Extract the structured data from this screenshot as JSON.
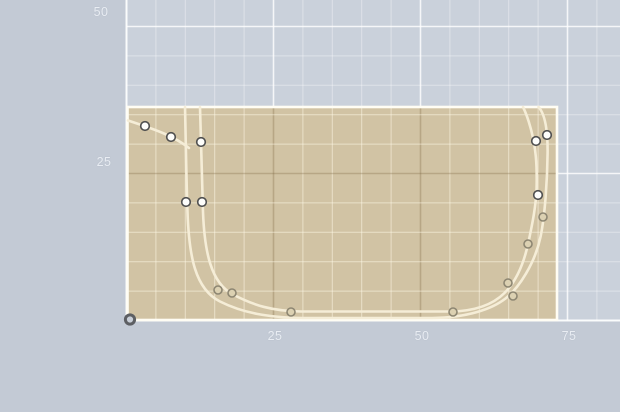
{
  "app": {
    "type": "2d-sketch-editor-canvas",
    "description": "CAD sketch canvas showing a filled profile sheet with bezier outline walls and control points"
  },
  "canvas": {
    "width": 620,
    "height": 412,
    "origin_px": {
      "x": 126.5,
      "y": 320.5
    },
    "px_per_unit": 5.88,
    "minor_step_units": 5,
    "major_step_units": 25,
    "colors": {
      "bg_outside": "#c3cad5",
      "bg_inside": "#cad1db",
      "grid_minor": "rgba(255,255,255,0.38)",
      "grid_major": "rgba(255,255,255,0.80)",
      "axis_line": "rgba(255,255,255,0.92)",
      "label_text": "#e9edf3",
      "sheet_fill": "#d1c3a4",
      "sheet_edge": "#fffdf4",
      "sheet_grid_minor": "rgba(255,250,232,0.55)",
      "sheet_grid_major": "rgba(122,100,62,0.30)",
      "curve": "#f5edd7",
      "point_bright_fill": "#fdfdfb",
      "point_bright_stroke": "#4f4f4f",
      "point_faint_fill": "#dcd1b2",
      "point_faint_stroke": "#8d8672",
      "origin_ring": "#5d5f63",
      "origin_fill": "#c9cfd8"
    }
  },
  "axis_labels": [
    {
      "axis": "y",
      "text": "50",
      "x": 101,
      "y": 12
    },
    {
      "axis": "y",
      "text": "25",
      "x": 104,
      "y": 162
    },
    {
      "axis": "x",
      "text": "25",
      "x": 275,
      "y": 336
    },
    {
      "axis": "x",
      "text": "50",
      "x": 422,
      "y": 336
    },
    {
      "axis": "x",
      "text": "75",
      "x": 569,
      "y": 336
    }
  ],
  "sheet": {
    "x": 127.5,
    "y": 107,
    "width": 429.5,
    "height": 213
  },
  "profile": {
    "stroke_width": 2.6,
    "paths": [
      {
        "name": "outer-wall-path",
        "d": "M 185,107 C 185.8,140 186.2,175 187.5,212 C 189,256 195,289 220,301.5 C 243,313 268,317.5 303,318 L 432,318 C 468,317.5 492,309 505.5,298.5 C 519,288 535,263 540.5,237 C 545,215.5 547.3,180 547.6,153 C 547.8,130 545,114 538.5,107"
      },
      {
        "name": "inner-wall-path",
        "d": "M 200,107 C 201,140 201.8,175 203,212 C 204.5,252 211,283 233,294.5 C 254,305.5 272,311 301,311.5 L 451,311.5 C 478,311 494,303.5 504.5,293 C 517,280.5 524.5,261 528.6,241.5 C 532.5,223 536,206 536.6,188 C 537.2,163 535.5,147 531.5,131.5 C 528.5,119.5 525.5,112 523,107"
      },
      {
        "name": "top-left-detail-path",
        "d": "M 128,120.5 C 137,123.5 151,128 164,133.5 C 173,137.5 182,142.5 189,148"
      }
    ],
    "control_points": [
      {
        "x": 145,
        "y": 126,
        "style": "bright"
      },
      {
        "x": 171,
        "y": 137,
        "style": "bright"
      },
      {
        "x": 201,
        "y": 142,
        "style": "bright"
      },
      {
        "x": 186,
        "y": 202,
        "style": "bright"
      },
      {
        "x": 202,
        "y": 202,
        "style": "bright"
      },
      {
        "x": 218,
        "y": 290,
        "style": "faint"
      },
      {
        "x": 232,
        "y": 293,
        "style": "faint"
      },
      {
        "x": 291,
        "y": 312,
        "style": "faint"
      },
      {
        "x": 453,
        "y": 312,
        "style": "faint"
      },
      {
        "x": 508,
        "y": 283,
        "style": "faint"
      },
      {
        "x": 513,
        "y": 296,
        "style": "faint"
      },
      {
        "x": 528,
        "y": 244,
        "style": "faint"
      },
      {
        "x": 543,
        "y": 217,
        "style": "faint"
      },
      {
        "x": 538,
        "y": 195,
        "style": "bright"
      },
      {
        "x": 536,
        "y": 141,
        "style": "bright"
      },
      {
        "x": 547,
        "y": 135,
        "style": "bright"
      }
    ]
  },
  "origin_marker": {
    "x": 130,
    "y": 319.5,
    "radius": 4.6,
    "ring_width": 3
  }
}
